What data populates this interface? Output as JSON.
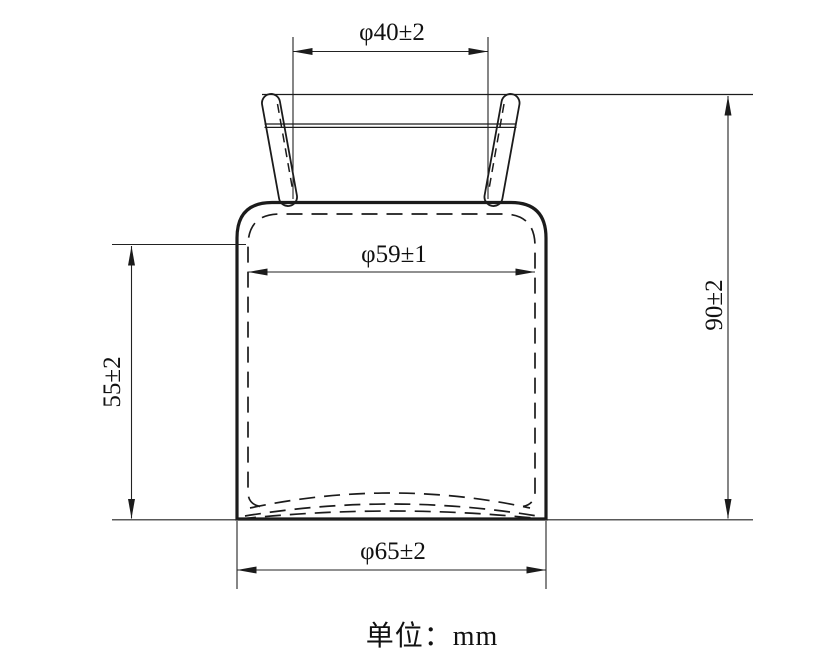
{
  "drawing": {
    "unit_label": "单位：mm",
    "dimensions": {
      "mouth_diameter": "φ40±2",
      "inner_diameter": "φ59±1",
      "body_height": "55±2",
      "overall_height": "90±2",
      "outer_diameter": "φ65±2"
    },
    "colors": {
      "line": "#1b1b1b",
      "dimension_line": "#222222",
      "background": "#ffffff"
    }
  }
}
